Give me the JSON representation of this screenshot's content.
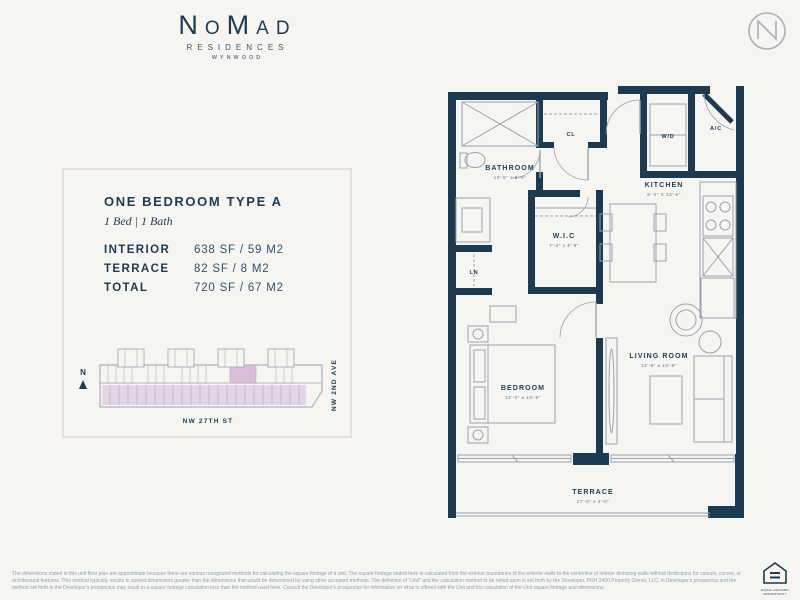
{
  "header": {
    "brand": "NoMad",
    "brand_sub1": "RESIDENCES",
    "brand_sub2": "WYNWOOD"
  },
  "unit_card": {
    "title": "ONE BEDROOM TYPE A",
    "subtitle": "1 Bed | 1 Bath",
    "stats": {
      "interior": {
        "label": "INTERIOR",
        "value": "638 SF / 59 M2"
      },
      "terrace": {
        "label": "TERRACE",
        "value": "82 SF / 8 M2"
      },
      "total": {
        "label": "TOTAL",
        "value": "720 SF / 67 M2"
      }
    },
    "sitemap": {
      "north_label": "N",
      "street_bottom": "NW 27TH ST",
      "street_right": "NW 2ND AVE"
    }
  },
  "floorplan": {
    "rooms": {
      "bathroom": {
        "label": "BATHROOM",
        "dims": "10'-6\" x 5'-6\""
      },
      "cl": {
        "label": "CL"
      },
      "wd": {
        "label": "W/D"
      },
      "ac": {
        "label": "A/C"
      },
      "kitchen": {
        "label": "KITCHEN",
        "dims": "8'-0\" X 13'-6\""
      },
      "wic": {
        "label": "W.I.C",
        "dims": "7'-4\" x 4'-9\""
      },
      "ln": {
        "label": "LN"
      },
      "bedroom": {
        "label": "BEDROOM",
        "dims": "13'-2\" x 10'-6\""
      },
      "living": {
        "label": "LIVING ROOM",
        "dims": "13'-9\" x 10'-8\""
      },
      "terrace": {
        "label": "TERRACE",
        "dims": "27'-0\" x 4'-0\""
      }
    }
  },
  "colors": {
    "background": "#f6f5f2",
    "wall_navy": "#1d3a50",
    "thin_line_gray": "#9aa3ad",
    "card_border_pink": "#eadbe7",
    "sitemap_fill_purple": "#e6d5e8",
    "sitemap_highlight_purple": "#d9bfdc",
    "disclaimer_gray": "#8aa0b4"
  },
  "footer": {
    "disclaimer": "The dimensions stated in this unit floor plan are approximate because there are various recognized methods for calculating the square footage of a unit. The square footage stated here is calculated from the exterior boundaries of the exterior walls to the centerline of interior demising walls without deductions for cutouts, curves, or architectural features. This method typically results in quoted dimensions greater than the dimensions that would be determined by using other accepted methods. The definition of \"Unit\" and the calculation method to be relied upon is set forth by the Developer, PRH 2400 Property Owner, LLC, in Developer's prospectus and the method set forth in the Developer's prospectus may result in a square footage calculation less than the method used here. Consult the Developer's prospectus for information on what is offered with the Unit and the calculation of the Unit square footage and dimensions.",
    "equal_housing_line1": "EQUAL HOUSING",
    "equal_housing_line2": "OPPORTUNITY"
  }
}
